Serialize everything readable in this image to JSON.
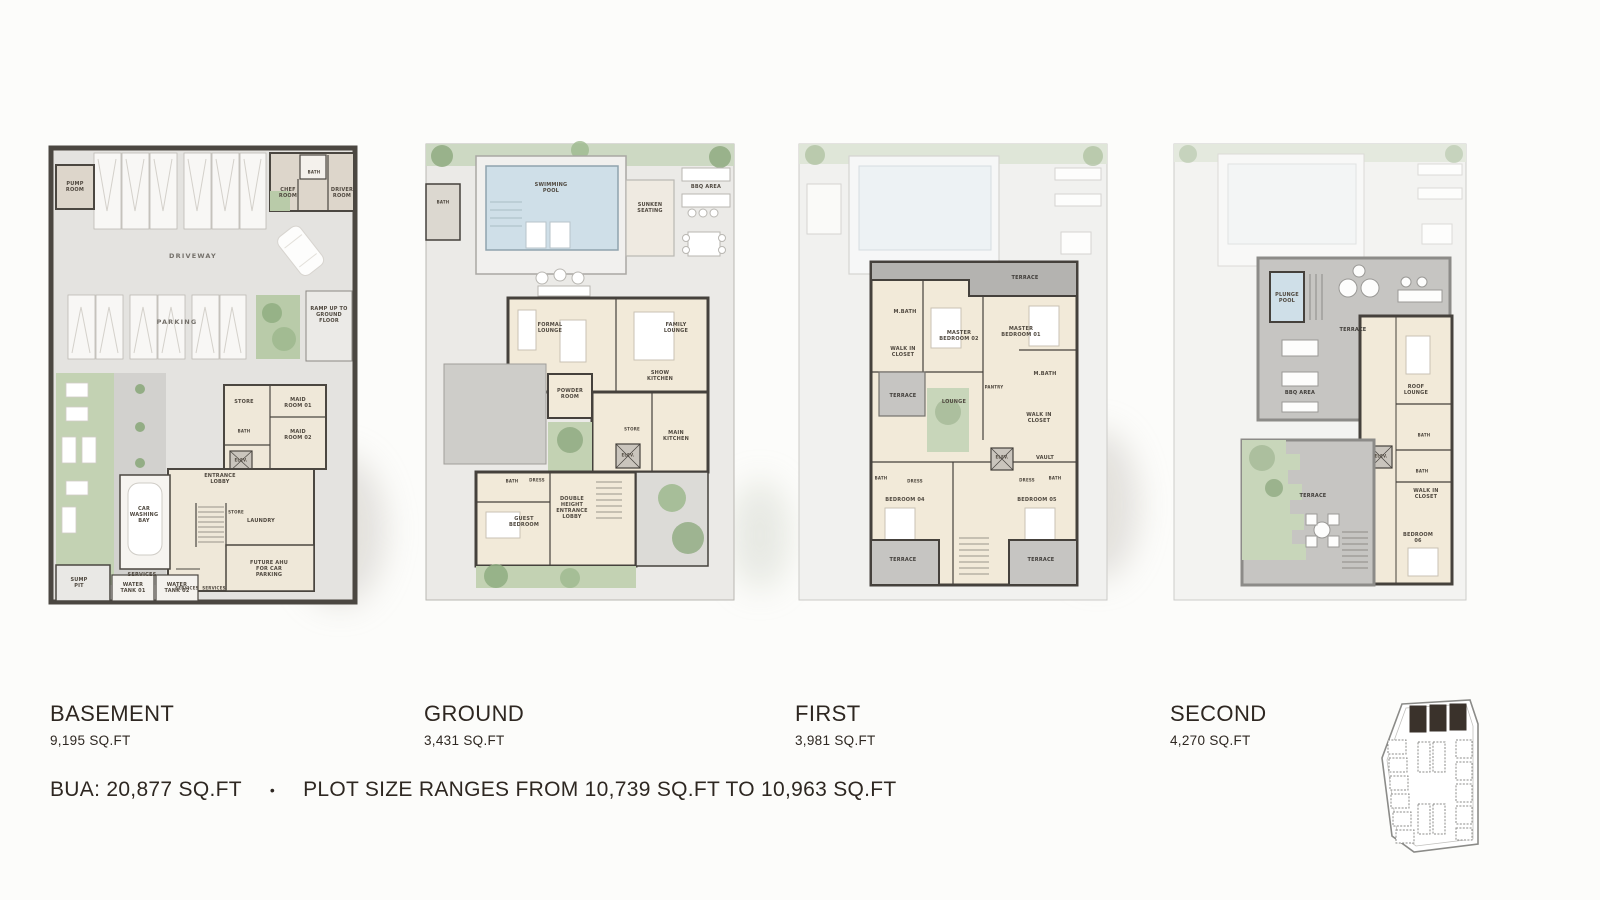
{
  "plans": [
    {
      "id": "basement",
      "title": "BASEMENT",
      "area": "9,195 SQ.FT",
      "rooms": {
        "pump_room": "PUMP ROOM",
        "bath_top": "BATH",
        "chef_room": "CHEF ROOM",
        "driver_room": "DRIVER ROOM",
        "driveway": "DRIVEWAY",
        "parking": "PARKING",
        "ramp": "RAMP UP TO GROUND FLOOR",
        "store": "STORE",
        "maid_room_01": "MAID ROOM 01",
        "maid_room_02": "MAID ROOM 02",
        "bath2": "BATH",
        "elev": "ELEV.",
        "entrance_lobby": "ENTRANCE LOBBY",
        "car_washing_bay": "CAR WASHING BAY",
        "store2": "STORE",
        "laundry": "LAUNDRY",
        "services": "SERVICES",
        "services2": "SERVICES",
        "services3": "SERVICES",
        "future_ahu": "FUTURE AHU FOR CAR PARKING",
        "sump_pit": "SUMP PIT",
        "water_tank_01": "WATER TANK 01",
        "water_tank_02": "WATER TANK 02"
      }
    },
    {
      "id": "ground",
      "title": "GROUND",
      "area": "3,431 SQ.FT",
      "rooms": {
        "bath": "BATH",
        "swimming_pool": "SWIMMING POOL",
        "sunken_seating": "SUNKEN SEATING",
        "bbq_area": "BBQ AREA",
        "formal_lounge": "FORMAL LOUNGE",
        "family_lounge": "FAMILY LOUNGE",
        "powder_room": "POWDER ROOM",
        "show_kitchen": "SHOW KITCHEN",
        "store": "STORE",
        "elev": "ELEV.",
        "main_kitchen": "MAIN KITCHEN",
        "bath2": "BATH",
        "dress": "DRESS",
        "guest_bedroom": "GUEST BEDROOM",
        "entrance_lobby": "DOUBLE HEIGHT ENTRANCE LOBBY"
      }
    },
    {
      "id": "first",
      "title": "FIRST",
      "area": "3,981 SQ.FT",
      "rooms": {
        "terrace_top": "TERRACE",
        "m_bath_left": "M.BATH",
        "master_bedroom_02": "MASTER BEDROOM 02",
        "master_bedroom_01": "MASTER BEDROOM 01",
        "walk_in_closet_left": "WALK IN CLOSET",
        "m_bath_right": "M.BATH",
        "terrace_left": "TERRACE",
        "lounge": "LOUNGE",
        "pantry": "PANTRY",
        "walk_in_closet_right": "WALK IN CLOSET",
        "elev": "ELEV.",
        "vault": "VAULT",
        "bath_left": "BATH",
        "dress_left": "DRESS",
        "dress_right": "DRESS",
        "bath_right": "BATH",
        "bedroom_04": "BEDROOM 04",
        "bedroom_05": "BEDROOM 05",
        "terrace_bl": "TERRACE",
        "terrace_br": "TERRACE"
      }
    },
    {
      "id": "second",
      "title": "SECOND",
      "area": "4,270 SQ.FT",
      "rooms": {
        "plunge_pool": "PLUNGE POOL",
        "terrace": "TERRACE",
        "bbq_area": "BBQ AREA",
        "roof_lounge": "ROOF LOUNGE",
        "bath1": "BATH",
        "elev": "ELEV.",
        "bath2": "BATH",
        "walk_in_closet": "WALK IN CLOSET",
        "terrace_lower": "TERRACE",
        "bedroom_06": "BEDROOM 06"
      }
    }
  ],
  "footer": {
    "bua": "BUA: 20,877 SQ.FT",
    "separator": "•",
    "plot_note": "PLOT SIZE RANGES FROM 10,739 SQ.FT TO 10,963 SQ.FT"
  },
  "key_plan": {
    "highlighted_plots": 3
  },
  "colors": {
    "text": "#2e2721",
    "wall": "#45413c",
    "interior": "#f2ead9",
    "site": "#e8e7e4",
    "green": "#bccdad",
    "pool": "#cfdfe8",
    "terrace": "#c6c5c2",
    "highlight_plot": "#3a322b"
  }
}
